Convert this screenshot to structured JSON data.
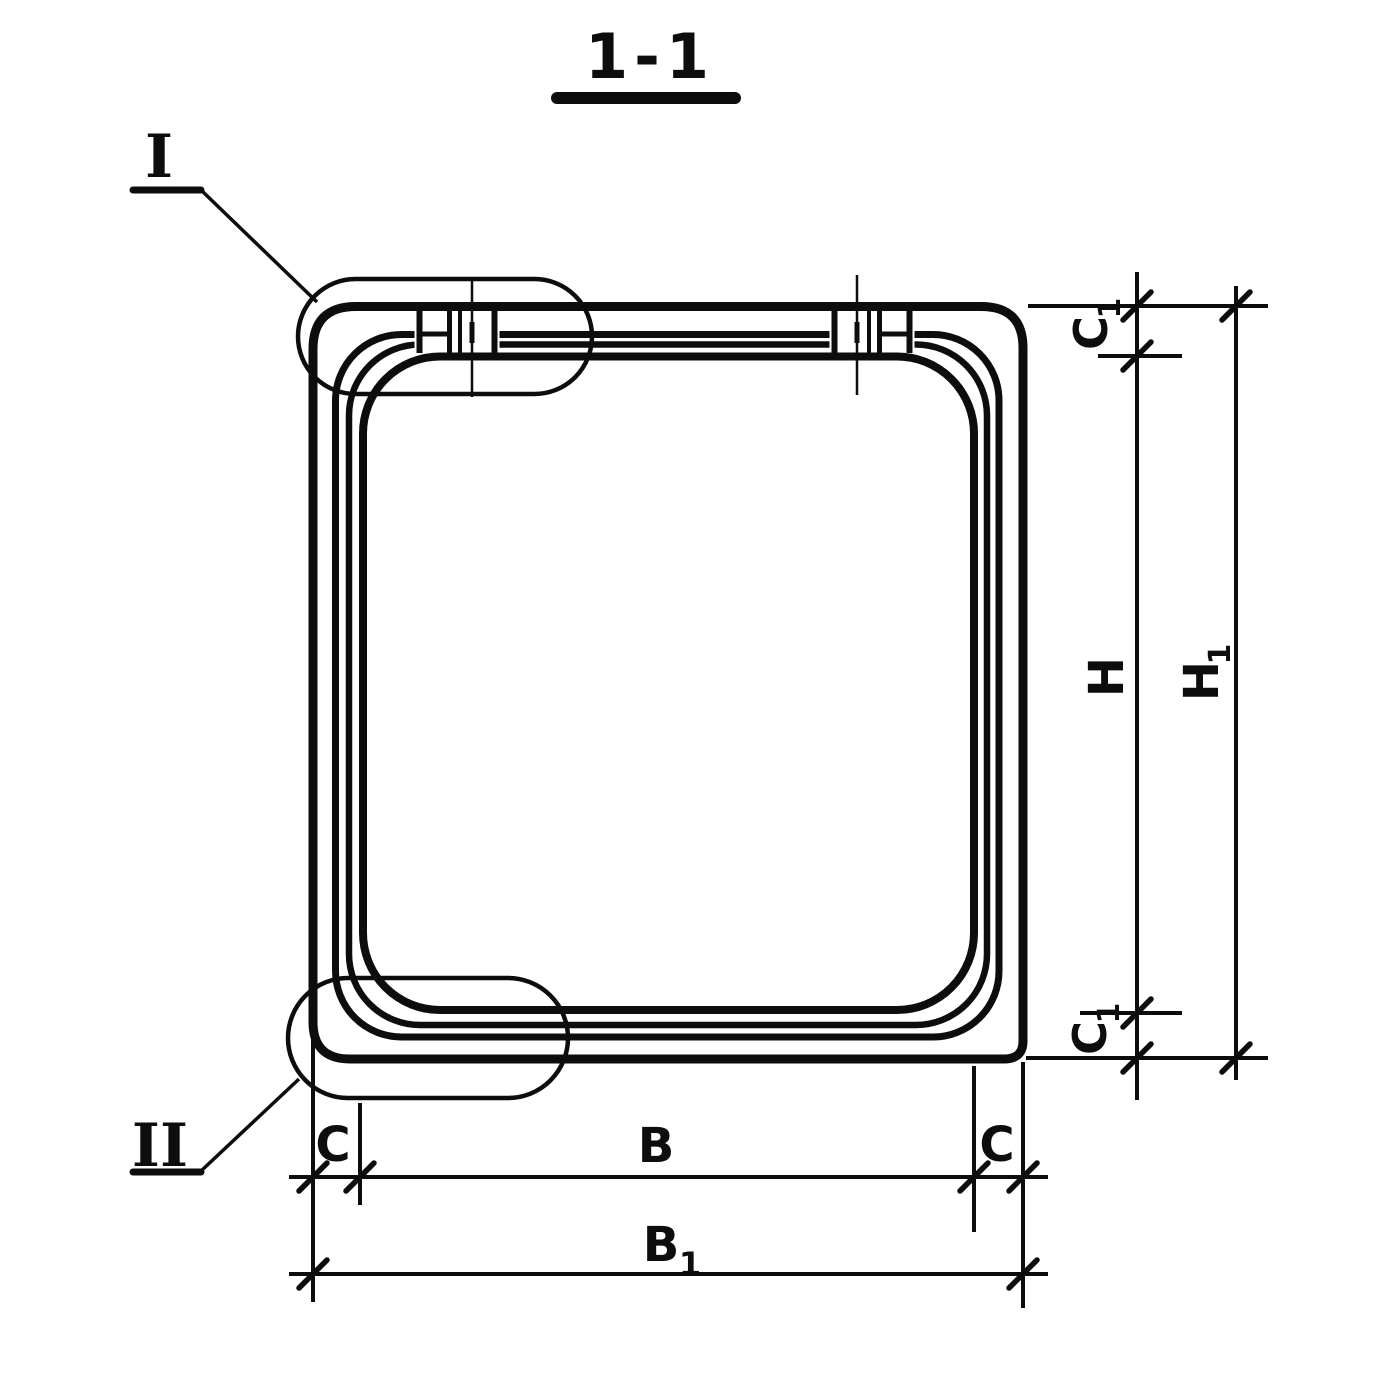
{
  "drawing": {
    "title": "1-1",
    "section_markers": {
      "top": "I",
      "bottom": "II"
    },
    "dimension_labels": {
      "c1_top": {
        "base": "C",
        "sub": "1"
      },
      "h": {
        "base": "H"
      },
      "h1": {
        "base": "H",
        "sub": "1"
      },
      "c1_bottom": {
        "base": "C",
        "sub": "1"
      },
      "c_left": {
        "base": "C"
      },
      "b": {
        "base": "B"
      },
      "c_right": {
        "base": "C"
      },
      "b1": {
        "base": "B",
        "sub": "1"
      }
    },
    "colors": {
      "ink": "#0d0d0d",
      "paper": "#ffffff"
    }
  }
}
